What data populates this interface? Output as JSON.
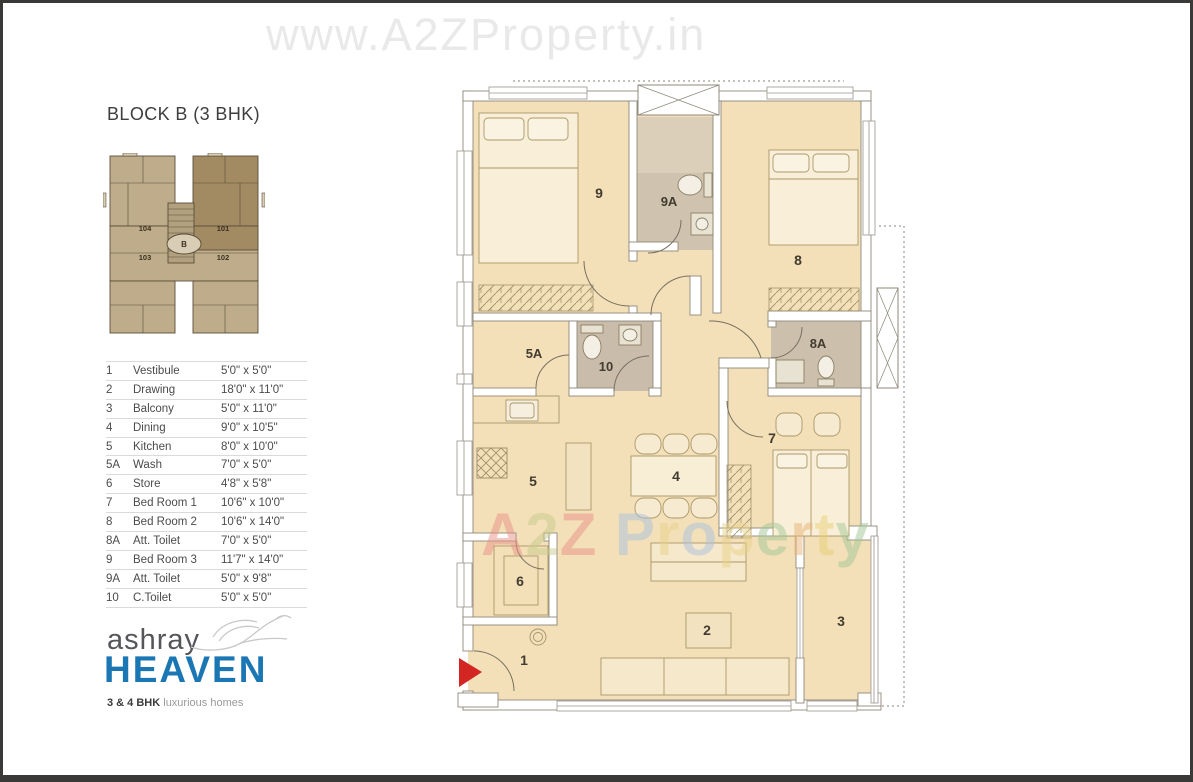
{
  "watermarks": {
    "top": "www.A2ZProperty.in",
    "center_letters": [
      {
        "ch": "A",
        "color": "#e99287"
      },
      {
        "ch": "2",
        "color": "#c9cc8b"
      },
      {
        "ch": "Z",
        "color": "#e99287"
      },
      {
        "ch": " ",
        "color": ""
      },
      {
        "ch": "P",
        "color": "#abc2e1"
      },
      {
        "ch": "r",
        "color": "#e7d28a"
      },
      {
        "ch": "o",
        "color": "#abc2e1"
      },
      {
        "ch": "p",
        "color": "#e7d28a"
      },
      {
        "ch": "e",
        "color": "#a3c897"
      },
      {
        "ch": "r",
        "color": "#e8b277"
      },
      {
        "ch": "t",
        "color": "#e9d077"
      },
      {
        "ch": "y",
        "color": "#a3c897"
      }
    ]
  },
  "header": {
    "title": "BLOCK B (3 BHK)"
  },
  "key_plan": {
    "units": [
      "104",
      "101",
      "103",
      "102"
    ],
    "block_label": "B"
  },
  "legend": {
    "rows": [
      {
        "no": "1",
        "name": "Vestibule",
        "size": "5'0\" x 5'0\""
      },
      {
        "no": "2",
        "name": "Drawing",
        "size": "18'0\" x 11'0\""
      },
      {
        "no": "3",
        "name": "Balcony",
        "size": "5'0\" x 11'0\""
      },
      {
        "no": "4",
        "name": "Dining",
        "size": "9'0\" x 10'5\""
      },
      {
        "no": "5",
        "name": "Kitchen",
        "size": "8'0\" x 10'0\""
      },
      {
        "no": "5A",
        "name": "Wash",
        "size": "7'0\" x 5'0\""
      },
      {
        "no": "6",
        "name": "Store",
        "size": "4'8\" x 5'8\""
      },
      {
        "no": "7",
        "name": "Bed Room 1",
        "size": "10'6\" x 10'0\""
      },
      {
        "no": "8",
        "name": "Bed Room 2",
        "size": "10'6\" x 14'0\""
      },
      {
        "no": "8A",
        "name": "Att. Toilet",
        "size": "7'0\" x 5'0\""
      },
      {
        "no": "9",
        "name": "Bed Room 3",
        "size": "11'7\" x 14'0\""
      },
      {
        "no": "9A",
        "name": "Att. Toilet",
        "size": "5'0\" x 9'8\""
      },
      {
        "no": "10",
        "name": "C.Toilet",
        "size": "5'0\" x 5'0\""
      }
    ]
  },
  "logo": {
    "brand": "ashray",
    "name": "HEAVEN",
    "tagline_bold": "3 & 4 BHK",
    "tagline": "luxurious homes"
  },
  "floor_plan": {
    "room_labels": {
      "r1": "1",
      "r2": "2",
      "r3": "3",
      "r4": "4",
      "r5": "5",
      "r5a": "5A",
      "r6": "6",
      "r7": "7",
      "r8": "8",
      "r8a": "8A",
      "r9": "9",
      "r9a": "9A",
      "r10": "10"
    }
  },
  "colors": {
    "logo_blue": "#1b76b4",
    "entry_arrow_red": "#d32522",
    "floor_cream": "#f3e0b8",
    "toilet_gray": "#c9bcaa",
    "keyplan_highlight": "#a28a62",
    "watermark_gray": "#e9e9e9"
  }
}
